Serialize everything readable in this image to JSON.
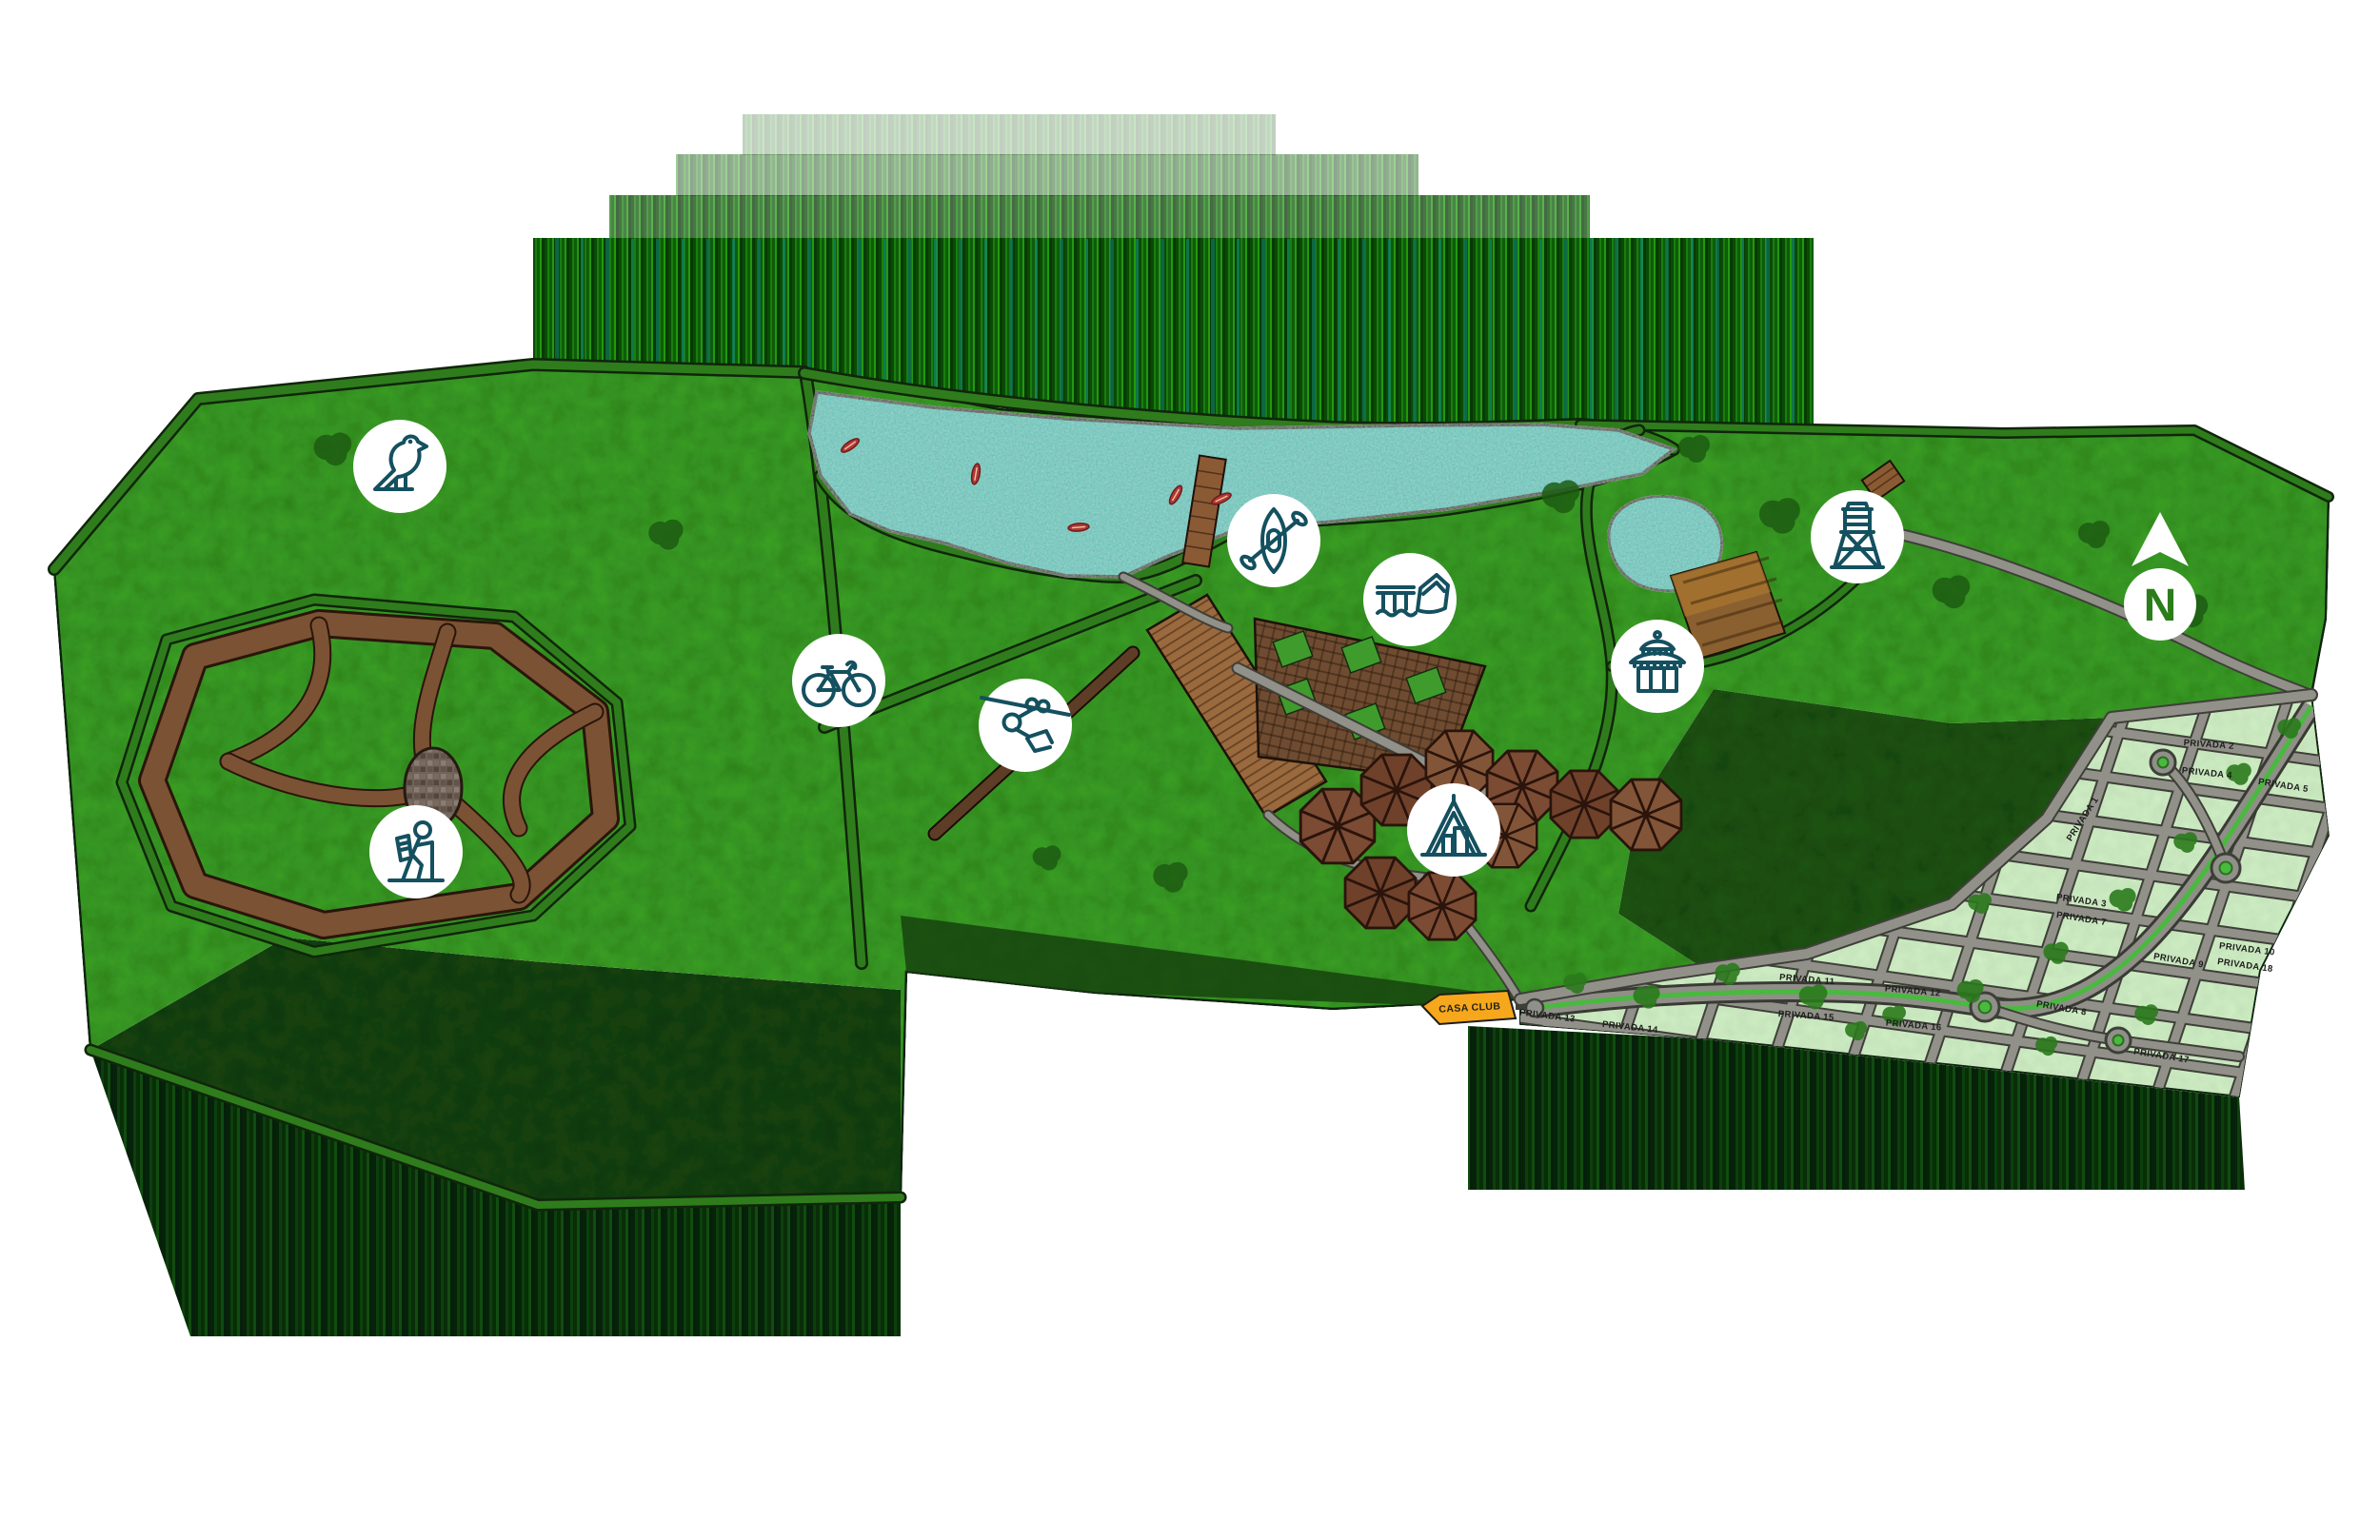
{
  "map": {
    "north": {
      "label": "N"
    },
    "casa_club": {
      "label": "CASA CLUB"
    },
    "streets": [
      {
        "label": "PRIVADA 1"
      },
      {
        "label": "PRIVADA 2"
      },
      {
        "label": "PRIVADA 3"
      },
      {
        "label": "PRIVADA 4"
      },
      {
        "label": "PRIVADA 5"
      },
      {
        "label": "PRIVADA 7"
      },
      {
        "label": "PRIVADA 8"
      },
      {
        "label": "PRIVADA 9"
      },
      {
        "label": "PRIVADA 10"
      },
      {
        "label": "PRIVADA 11"
      },
      {
        "label": "PRIVADA 12"
      },
      {
        "label": "PRIVADA 13"
      },
      {
        "label": "PRIVADA 14"
      },
      {
        "label": "PRIVADA 15"
      },
      {
        "label": "PRIVADA 16"
      },
      {
        "label": "PRIVADA 17"
      },
      {
        "label": "PRIVADA 18"
      }
    ],
    "amenities": [
      {
        "icon": "bird-icon"
      },
      {
        "icon": "kayak-icon"
      },
      {
        "icon": "dock-boat-icon"
      },
      {
        "icon": "bicycle-icon"
      },
      {
        "icon": "zipline-icon"
      },
      {
        "icon": "hiker-icon"
      },
      {
        "icon": "tent-icon"
      },
      {
        "icon": "palapa-hut-icon"
      },
      {
        "icon": "water-tower-icon"
      }
    ],
    "colors": {
      "forest": "#3aa024",
      "forest_dark": "#16430e",
      "water": "#45c2b6",
      "trail_brown": "#7b5234",
      "subdivision": "#cfeec4",
      "road_gray": "#91918a",
      "median_green": "#49b93f",
      "icon_stroke": "#14505f",
      "casa_club_fill": "#f6a71b",
      "canoe_red": "#b23737"
    }
  }
}
